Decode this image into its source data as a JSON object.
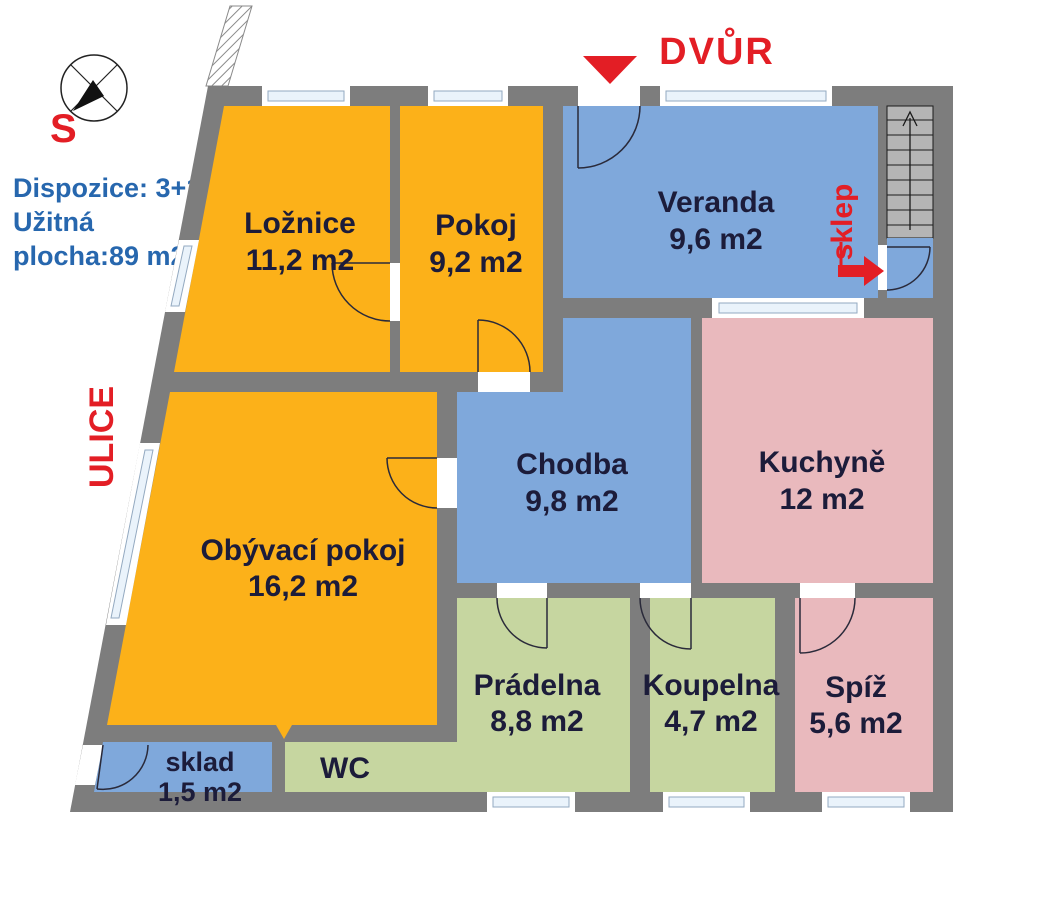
{
  "info_panel": {
    "line1": "Dispozice: 3+1",
    "line2": "Užitná",
    "line3": "plocha:89 m2"
  },
  "annotations": {
    "courtyard": "DVŮR",
    "street": "ULICE",
    "cellar": "sklep",
    "compass_south": "S"
  },
  "rooms": [
    {
      "id": "loznice",
      "name": "Ložnice",
      "area": "11,2 m2"
    },
    {
      "id": "pokoj",
      "name": "Pokoj",
      "area": "9,2 m2"
    },
    {
      "id": "veranda",
      "name": "Veranda",
      "area": "9,6 m2"
    },
    {
      "id": "chodba",
      "name": "Chodba",
      "area": "9,8 m2"
    },
    {
      "id": "kuchyne",
      "name": "Kuchyně",
      "area": "12 m2"
    },
    {
      "id": "obyvaci-pokoj",
      "name": "Obývací pokoj",
      "area": "16,2 m2"
    },
    {
      "id": "pradelna",
      "name": "Prádelna",
      "area": "8,8 m2"
    },
    {
      "id": "koupelna",
      "name": "Koupelna",
      "area": "4,7 m2"
    },
    {
      "id": "spiz",
      "name": "Spíž",
      "area": "5,6 m2"
    },
    {
      "id": "sklad",
      "name": "sklad",
      "area": "1,5 m2"
    },
    {
      "id": "wc",
      "name": "WC",
      "area": ""
    }
  ],
  "colors": {
    "wall": "#7d7d7d",
    "room_orange": "#fcb119",
    "room_blue": "#7fa8db",
    "room_pink": "#e9b9bd",
    "room_green": "#c6d6a0",
    "stairs": "#b5b5b5",
    "accent_red": "#e31e25",
    "info_blue": "#2767ae",
    "label": "#1c1c3a",
    "window_fill": "#eaf3fb",
    "window_stroke": "#93a9c0"
  }
}
